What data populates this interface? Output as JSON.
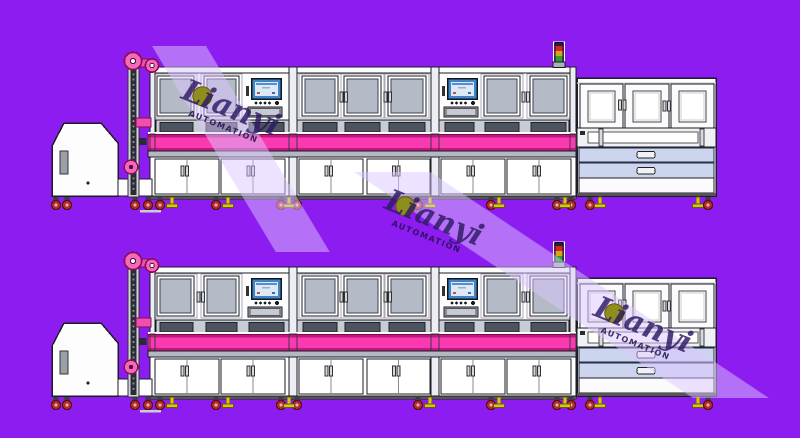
{
  "scene": {
    "type": "cad-equipment-side-view",
    "description": "Two identical automated production line machines (hopper feeder, chain elevator, three-bay main line with HMI panels, magenta transfer conveyor, offload station with drawers) drawn side-view on a purple background",
    "row_count": 2,
    "rows": [
      {
        "label": "assembly-line-row-1"
      },
      {
        "label": "assembly-line-row-2"
      }
    ]
  },
  "watermark": {
    "brand": "Lianyi",
    "subtitle": "AUTOMATION",
    "instance_count": 3
  },
  "colors": {
    "bg": "#8c1cf0",
    "line": "#1c1c24",
    "white": "#fdfdfe",
    "panel": "#eceef4",
    "glass": "#b4bac6",
    "glassDark": "#3a4150",
    "recessBg": "#c8ccd4",
    "recessSlot": "#4d5461",
    "magenta": "#fa3ab0",
    "magentaDark": "#c0187e",
    "railGray": "#b4b8c2",
    "drawer": "#ccd4ee",
    "wheelRed": "#b62a2a",
    "wheelDark": "#551111",
    "footYellow": "#d9c41e",
    "pulleyPink": "#f468bc",
    "pulleyRim": "#8a0c55",
    "chainDark": "#2c2c34",
    "screenBlue": "#3e86c8",
    "screenFace": "#ddeaf6",
    "signalRed": "#d42424",
    "signalAmber": "#d6a60e",
    "signalGreen": "#2aa32a",
    "towerGray": "#aab0bc",
    "stripe": "#dcc6ff",
    "wmText": "#2c1a63",
    "wmSub": "#201048",
    "wmCircle": "#8e8e1e",
    "dash": "#cbcbd0",
    "handle": "#d6d6de"
  }
}
